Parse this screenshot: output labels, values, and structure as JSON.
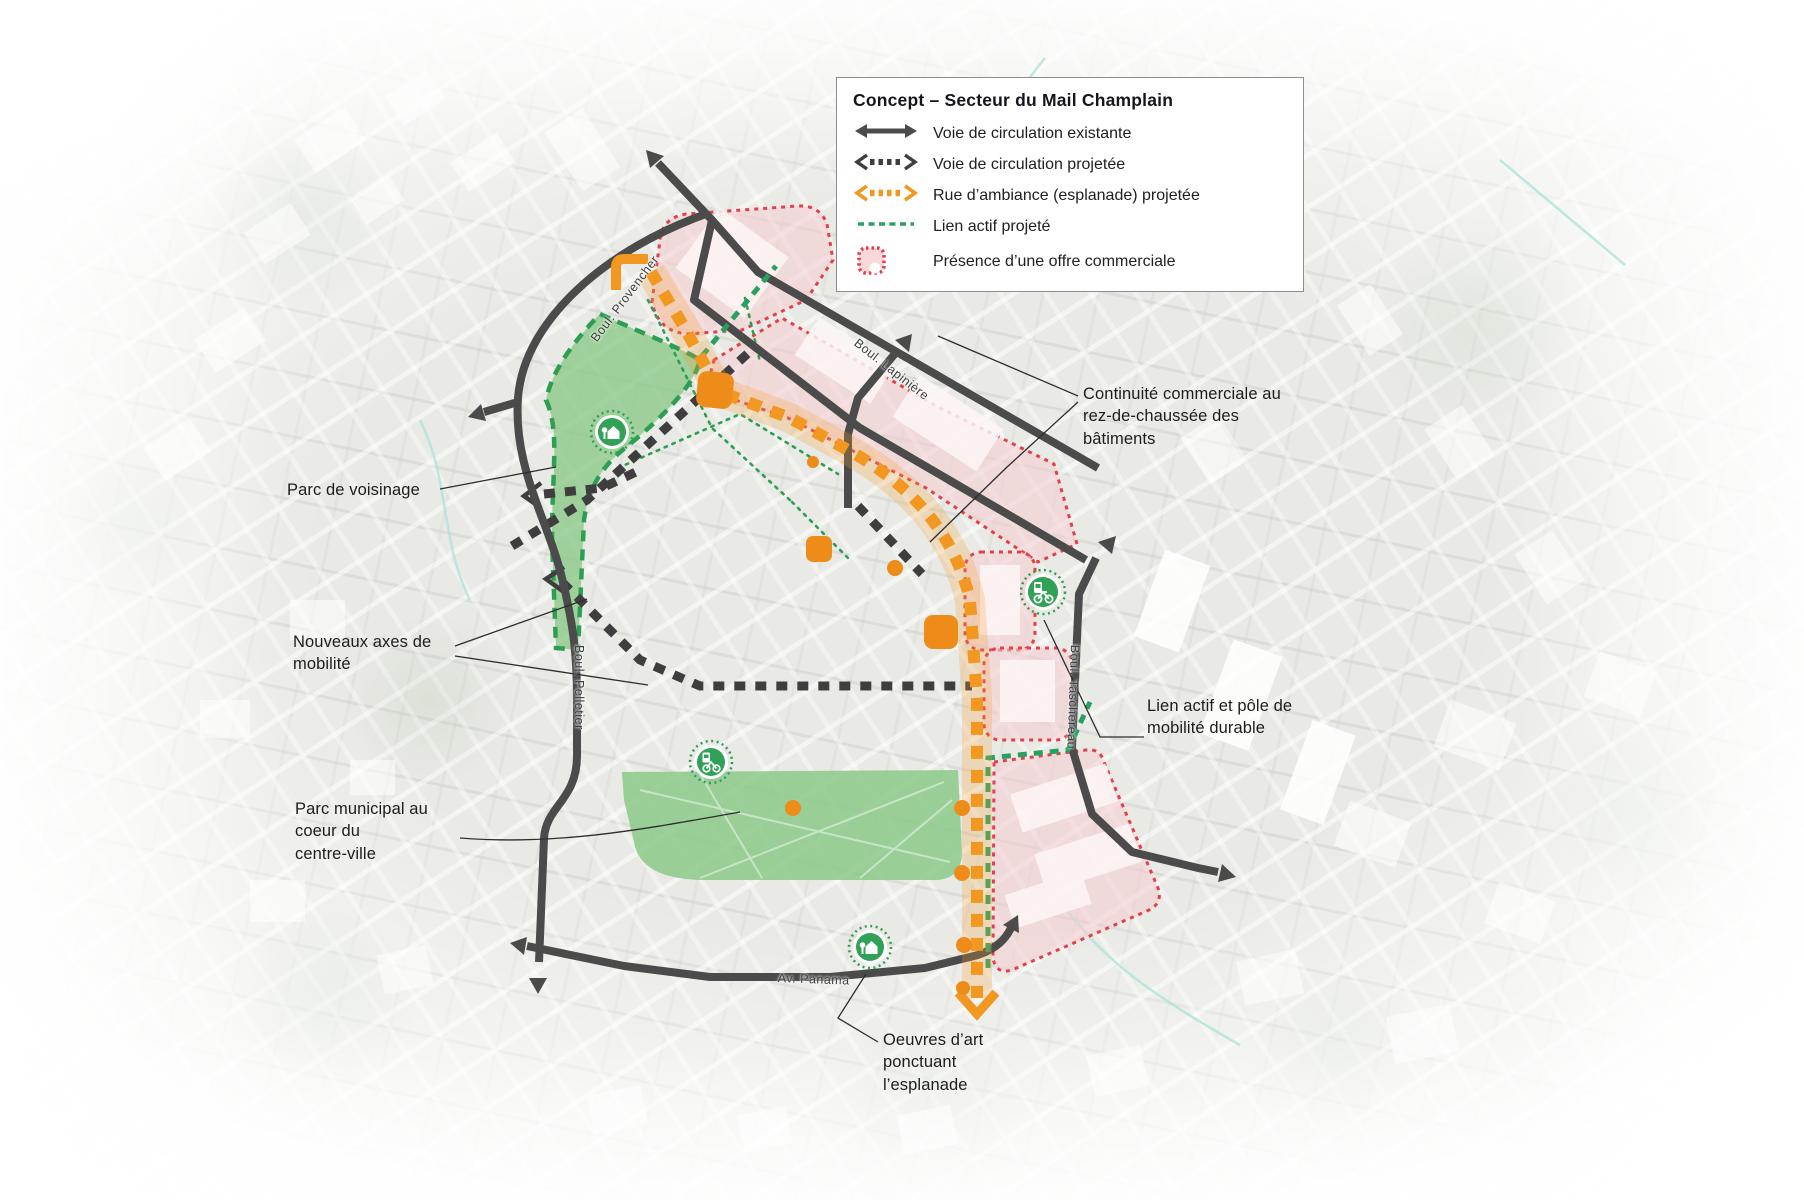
{
  "legend": {
    "title": "Concept – Secteur du Mail Champlain",
    "items": [
      {
        "icon": "existing-road-arrow",
        "label": "Voie de circulation existante",
        "color": "#4b4b4b"
      },
      {
        "icon": "projected-road-arrow",
        "label": "Voie de circulation projetée",
        "color": "#3e3e3e"
      },
      {
        "icon": "esplanade-street-arrow",
        "label": "Rue d’ambiance (esplanade) projetée",
        "color": "#f2971f"
      },
      {
        "icon": "active-link-dash",
        "label": "Lien actif projeté",
        "color": "#27a060"
      },
      {
        "icon": "commercial-area-swatch",
        "label": "Présence d’une offre commerciale",
        "color": "#e2404a"
      }
    ]
  },
  "annotations": {
    "parc_voisinage": "Parc de voisinage",
    "nouveaux_axes": "Nouveaux axes de\nmobilité",
    "parc_municipal": "Parc municipal au\ncoeur du\ncentre-ville",
    "continuite": "Continuité commerciale au\nrez-de-chaussée des\nbâtiments",
    "lien_actif": "Lien actif et pôle de\nmobilité durable",
    "oeuvres": "Oeuvres d’art\nponctuant\nl’esplanade"
  },
  "streets": {
    "provencher": "Boul. Provencher",
    "lapiniere": "Boul. Lapinière",
    "pelletier": "Boul. Pelletier",
    "taschereau": "Boul. Taschereau",
    "panama": "Av. Panama"
  },
  "map_symbols": {
    "park_marker": "house-in-green-circle-icon",
    "mobility_marker": "bike-charging-station-in-green-circle-icon",
    "esplanade_square": "orange-public-space-square",
    "esplanade_dot": "orange-art-dot",
    "esplanade_corner": "orange-corner-bracket"
  },
  "colors": {
    "existing_road": "#4b4b4b",
    "projected_road": "#3e3e3e",
    "esplanade_orange": "#f2971f",
    "active_link_green": "#27a060",
    "park_green": "#8cc98a",
    "commercial_fill": "#f5ccd0",
    "commercial_border": "#e2404a"
  }
}
